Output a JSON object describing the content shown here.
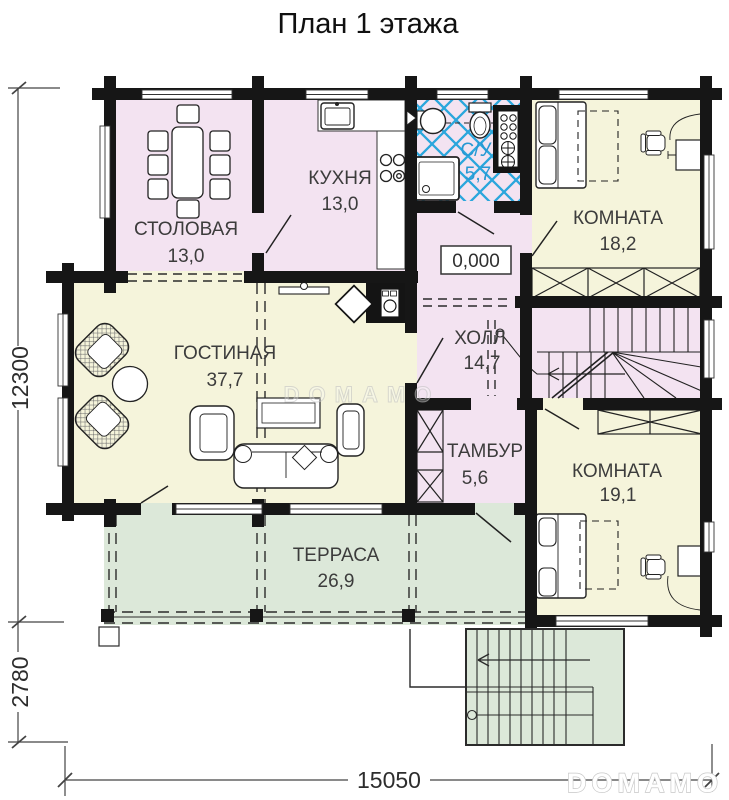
{
  "title": "План 1 этажа",
  "rooms": {
    "dining": {
      "name": "СТОЛОВАЯ",
      "area": "13,0"
    },
    "kitchen": {
      "name": "КУХНЯ",
      "area": "13,0"
    },
    "bathroom": {
      "name": "С/У",
      "area": "5,7"
    },
    "bedroom1": {
      "name": "КОМНАТА",
      "area": "18,2"
    },
    "living": {
      "name": "ГОСТИНАЯ",
      "area": "37,7"
    },
    "hall": {
      "name": "ХОЛЛ",
      "area": "14,7"
    },
    "vestibule": {
      "name": "ТАМБУР",
      "area": "5,6"
    },
    "bedroom2": {
      "name": "КОМНАТА",
      "area": "19,1"
    },
    "terrace": {
      "name": "ТЕРРАСА",
      "area": "26,9"
    }
  },
  "elevation_marker": "0,000",
  "dimensions": {
    "left_main": "12300",
    "left_porch": "2780",
    "bottom": "15050"
  },
  "watermark": {
    "center": "DOMAMO",
    "corner": "DOMAMO"
  },
  "colors": {
    "room_pink": "#f3e3f1",
    "room_yellow": "#f5f4db",
    "terrace_green": "#dce8d9",
    "tile_blue": "#2aa6dc",
    "wall_black": "#161616",
    "label_blue": "#2798d3"
  }
}
